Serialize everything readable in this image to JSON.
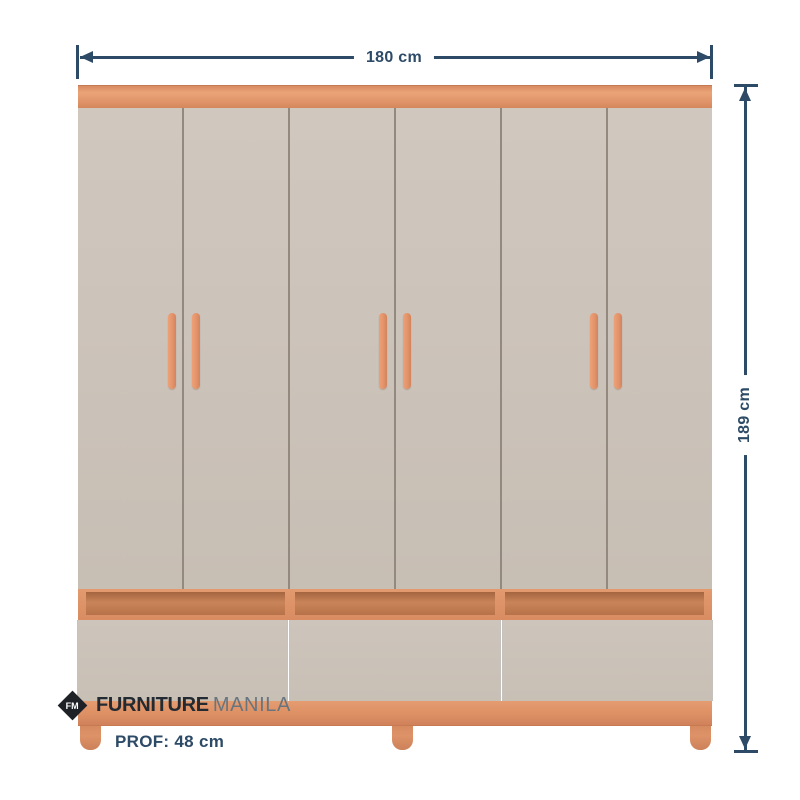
{
  "dimensions": {
    "width": {
      "label": "180 cm"
    },
    "height": {
      "label": "189 cm"
    },
    "depth": {
      "label": "PROF: 48 cm"
    },
    "line_color": "#2d4a66"
  },
  "brand": {
    "monogram": "FM",
    "name_primary": "FURNITURE",
    "name_secondary": "MANILA",
    "primary_color": "#232a31",
    "secondary_color": "#68757f"
  },
  "wardrobe": {
    "door_count": 6,
    "handle_pair_gap_indices": [
      1,
      3,
      5
    ],
    "drawer_count": 3,
    "leg_count": 3,
    "colors": {
      "wood": "#de9166",
      "wood_dark": "#bc7750",
      "door": "#cbc2b9",
      "gap_line": "#93897f"
    }
  }
}
